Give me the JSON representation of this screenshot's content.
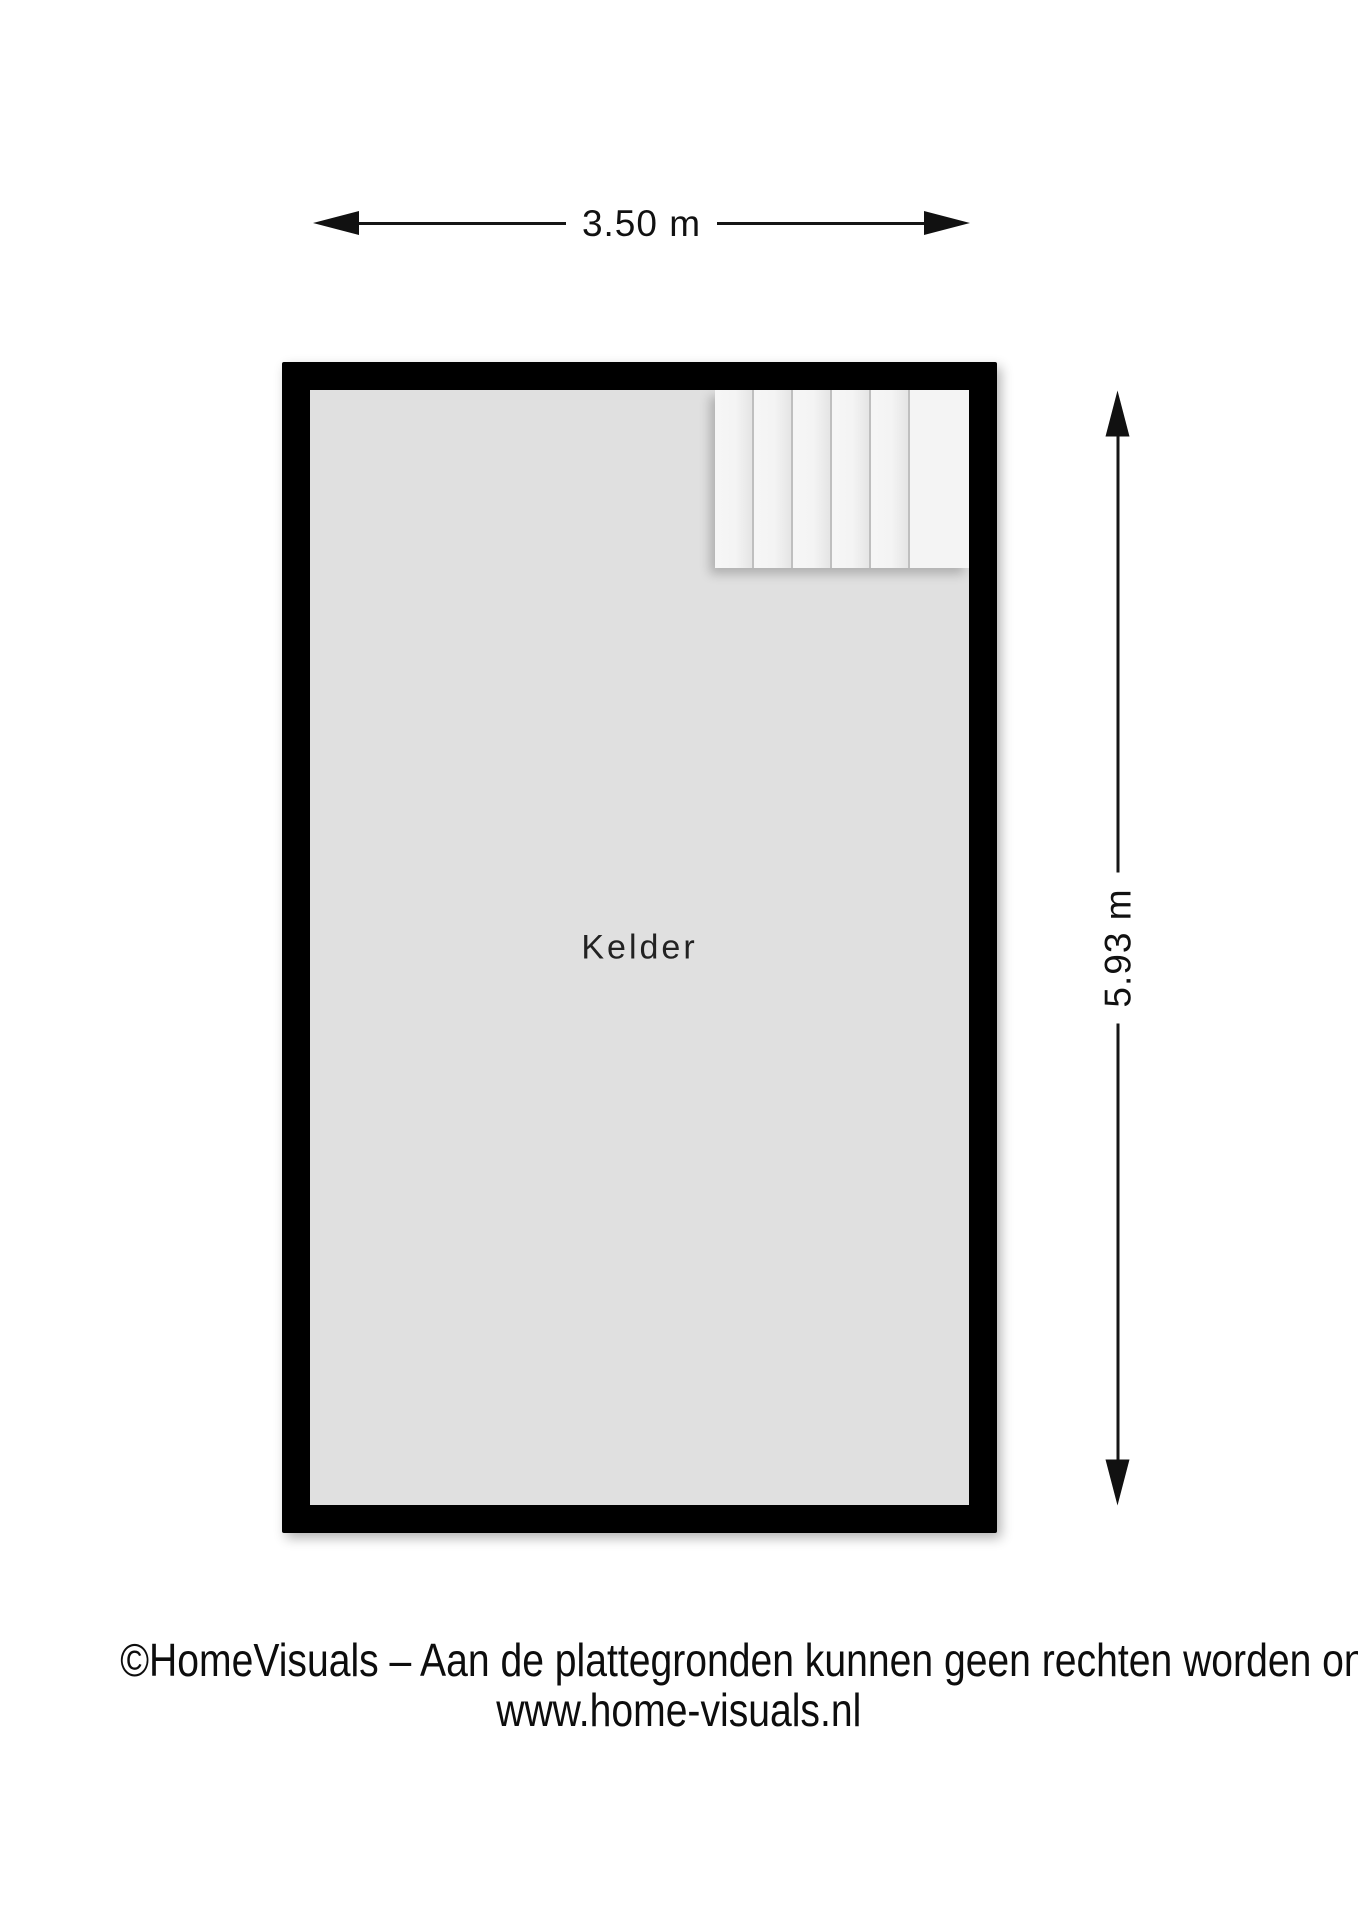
{
  "dimensions": {
    "width_label": "3.50 m",
    "height_label": "5.93 m"
  },
  "room": {
    "label": "Kelder"
  },
  "stairs": {
    "steps": 6
  },
  "footer": {
    "line1": "©HomeVisuals – Aan de plattegronden kunnen geen rechten worden ontleend.",
    "line2": "www.home-visuals.nl"
  },
  "colors": {
    "wall": "#000000",
    "floor": "#e0e0e0",
    "stair": "#f5f5f5",
    "background": "#ffffff"
  }
}
